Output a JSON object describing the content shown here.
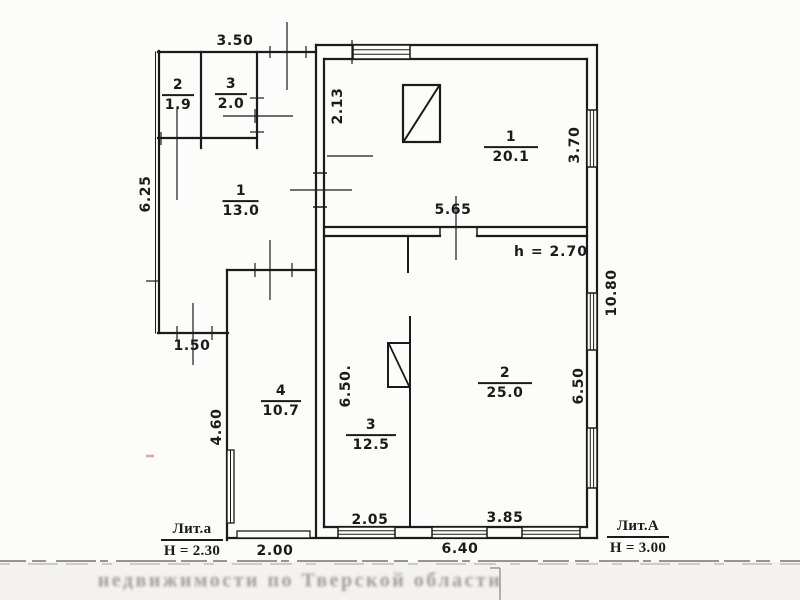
{
  "rooms": [
    {
      "number": "2",
      "area": "1.9"
    },
    {
      "number": "3",
      "area": "2.0"
    },
    {
      "number": "1",
      "area": "13.0"
    },
    {
      "number": "1",
      "area": "20.1"
    },
    {
      "number": "2",
      "area": "25.0"
    },
    {
      "number": "3",
      "area": "12.5"
    },
    {
      "number": "4",
      "area": "10.7"
    }
  ],
  "dims": {
    "w350": "3.50",
    "w625": "6.25",
    "w213": "2.13",
    "w370": "3.70",
    "w565": "5.65",
    "w1080": "10.80",
    "w650a": "6.50.",
    "w650b": "6.50",
    "w150": "1.50",
    "w460": "4.60",
    "w200": "2.00",
    "w205": "2.05",
    "w385": "3.85",
    "w640": "6.40"
  },
  "note": {
    "ceiling_height": "h = 2.70"
  },
  "literas": {
    "small": {
      "label": "Лит.а",
      "height": "Н = 2.30"
    },
    "big": {
      "label": "Лит.А",
      "height": "Н = 3.00"
    }
  },
  "stamp": {
    "text": "недвижимости по Тверской области"
  },
  "colors": {
    "ink": "#1b1b1b",
    "paper": "#fcfcfa",
    "stamp_gray": "#918f88"
  }
}
